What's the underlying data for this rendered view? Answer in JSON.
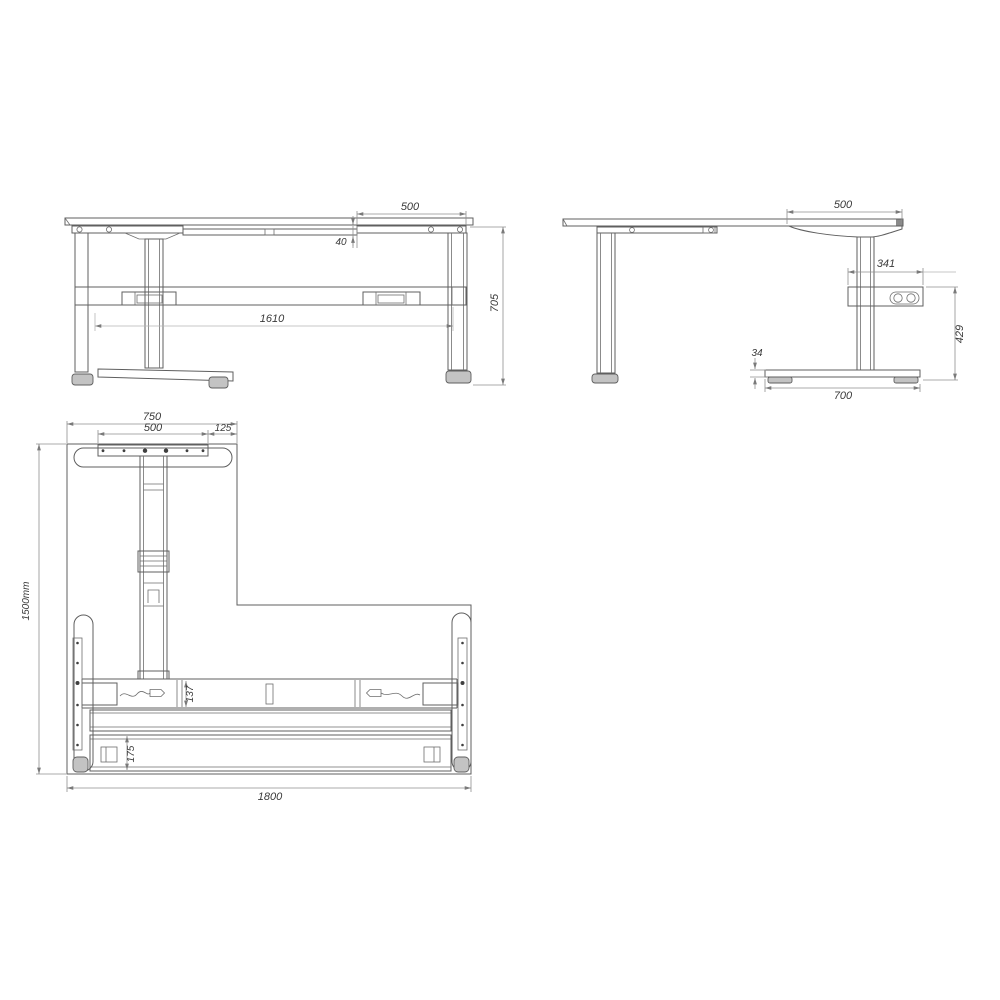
{
  "drawing": {
    "type": "technical-dimension-drawing",
    "subject": "height-adjustable L-shaped desk frame",
    "background_color": "#ffffff",
    "line_color": "#5f5f5f",
    "dimension_line_color": "#8f8f8f",
    "text_color": "#3a3a3a"
  },
  "views": {
    "front": {
      "label": "front-view",
      "dims": {
        "top_section_width": "500",
        "rail_offset": "40",
        "leg_span": "1610",
        "frame_height": "705"
      }
    },
    "side": {
      "label": "side-view",
      "dims": {
        "top_bracket_width": "500",
        "control_box_width": "341",
        "control_box_height": "429",
        "foot_height": "34",
        "foot_length": "700"
      }
    },
    "plan": {
      "label": "plan-view",
      "dims": {
        "return_width": "750",
        "bracket_width": "500",
        "edge_offset": "125",
        "overall_depth": "1500mm",
        "beam_width": "137",
        "rear_rail_width": "175",
        "overall_width": "1800"
      }
    }
  }
}
